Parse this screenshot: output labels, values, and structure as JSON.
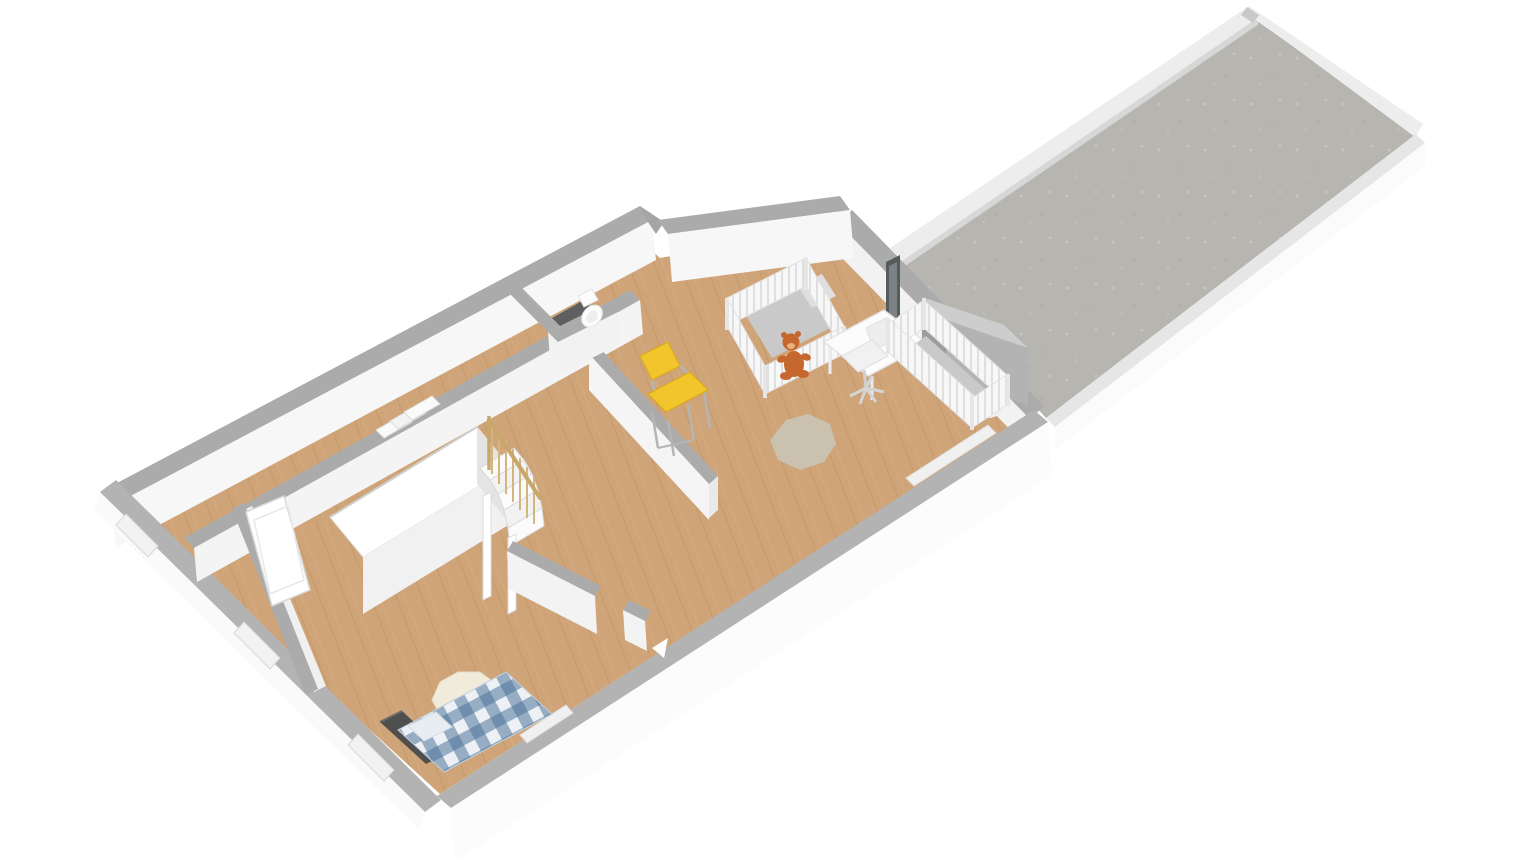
{
  "scene": {
    "type": "3d-floorplan-render",
    "view": "axonometric-top-down",
    "background": "#ffffff"
  },
  "colors": {
    "background": "#ffffff",
    "wall_top": "#ababab",
    "wall_top_light": "#b3b3b3",
    "wall_face": "#f7f7f7",
    "wall_face_bright": "#fcfcfc",
    "wall_face_soft": "#f3f3f3",
    "parapet": "#ededed",
    "parapet_cap": "#e6e6e6",
    "wood_floor": "#cfa478",
    "wood_plank_line": "#bc8d58",
    "concrete": "#b7b5b0",
    "concrete_speckle": "#c6c4bf",
    "dark_floor": "#5f5f5f",
    "plaid_light": "#edf1f5",
    "plaid_dark": "#4f749b",
    "headboard": "#4f4f4f",
    "sheepskin": "#f1ebdc",
    "crib_white": "#f7f7f7",
    "crib_slat_line": "#d9d9d9",
    "mattress": "#c9c9c9",
    "pillow": "#dfdfdf",
    "teddy": "#c5672e",
    "teddy_muzzle": "#e8b179",
    "desk": "#fcfcfc",
    "chair_yellow": "#f2c52d",
    "chair_yellow_dark": "#d9a913",
    "chrome": "#b5b5b5",
    "rug": "#c9c3b1",
    "railing_wood": "#c8a76a",
    "railing_spindle": "#d2b67e",
    "chimney_top": "#cdcdcd",
    "chimney_side": "#b3b3b3",
    "chimney_end": "#9c9c9c",
    "door_glass": "#565b5e",
    "door_white": "#ffffff",
    "window_recess": "#f2f2f2",
    "toilet": "#fdfdfd"
  },
  "rooms": [
    {
      "id": "corridor",
      "floor": "wood"
    },
    {
      "id": "hallway",
      "floor": "wood"
    },
    {
      "id": "bedroom",
      "floor": "wood"
    },
    {
      "id": "wc",
      "floor": "dark-tile"
    },
    {
      "id": "landing-stairwell",
      "floor": "wood"
    },
    {
      "id": "nursery",
      "floor": "wood"
    },
    {
      "id": "roof-terrace",
      "floor": "concrete"
    }
  ],
  "furniture": [
    {
      "id": "double-bed",
      "room": "bedroom",
      "detail": "blue-white plaid duvet, dark headboard"
    },
    {
      "id": "sheepskin-rug",
      "room": "bedroom"
    },
    {
      "id": "wardrobe-volume",
      "room": "bedroom"
    },
    {
      "id": "winder-staircase",
      "room": "landing-stairwell",
      "detail": "wood balustrade"
    },
    {
      "id": "toilet",
      "room": "wc"
    },
    {
      "id": "crib-1",
      "room": "nursery"
    },
    {
      "id": "crib-2",
      "room": "nursery"
    },
    {
      "id": "desk",
      "room": "nursery"
    },
    {
      "id": "office-chair",
      "room": "nursery"
    },
    {
      "id": "yellow-chair",
      "room": "nursery"
    },
    {
      "id": "teddy-bear",
      "room": "nursery"
    },
    {
      "id": "nursery-rug",
      "room": "nursery"
    },
    {
      "id": "chimney-block",
      "room": "roof-terrace"
    },
    {
      "id": "terrace-door",
      "room": "nursery"
    }
  ]
}
